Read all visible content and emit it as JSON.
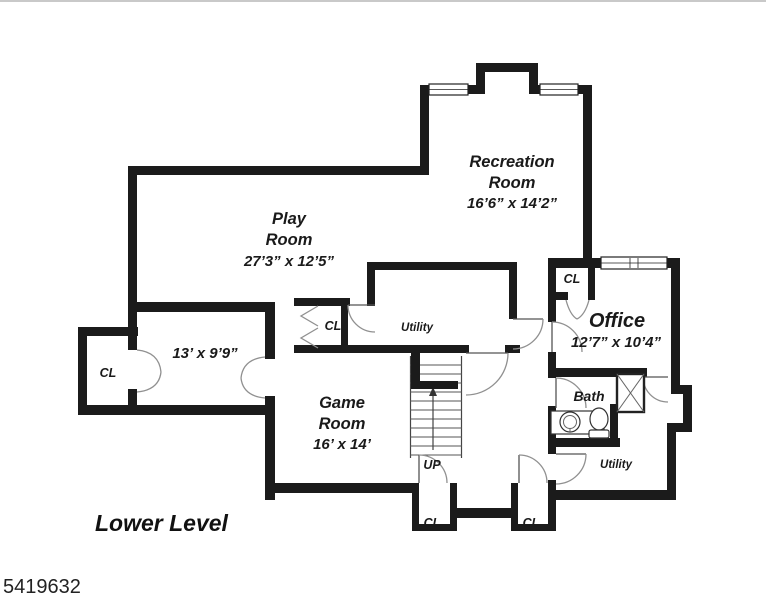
{
  "title": {
    "level_label": "Lower Level",
    "photo_id": "5419632"
  },
  "rooms": {
    "play": {
      "line1": "Play",
      "line2": "Room",
      "dims": "27’3” x 12’5”"
    },
    "recreation": {
      "line1": "Recreation",
      "line2": "Room",
      "dims": "16’6” x 14’2”"
    },
    "game": {
      "line1": "Game",
      "line2": "Room",
      "dims": "16’ x 14’"
    },
    "office": {
      "name": "Office",
      "dims": "12’7” x 10’4”"
    },
    "left_room": {
      "dims": "13’ x 9’9”"
    },
    "bath": {
      "name": "Bath"
    },
    "utility_center": {
      "name": "Utility"
    },
    "utility_right": {
      "name": "Utility"
    },
    "stairs": {
      "direction_label": "UP"
    }
  },
  "closets": {
    "left": "CL",
    "center": "CL",
    "office": "CL",
    "bottom_left": "CL",
    "bottom_right": "CL"
  },
  "colors": {
    "wall": "#1b1b1b",
    "door_arc": "#909090",
    "text": "#1a1a1a"
  }
}
